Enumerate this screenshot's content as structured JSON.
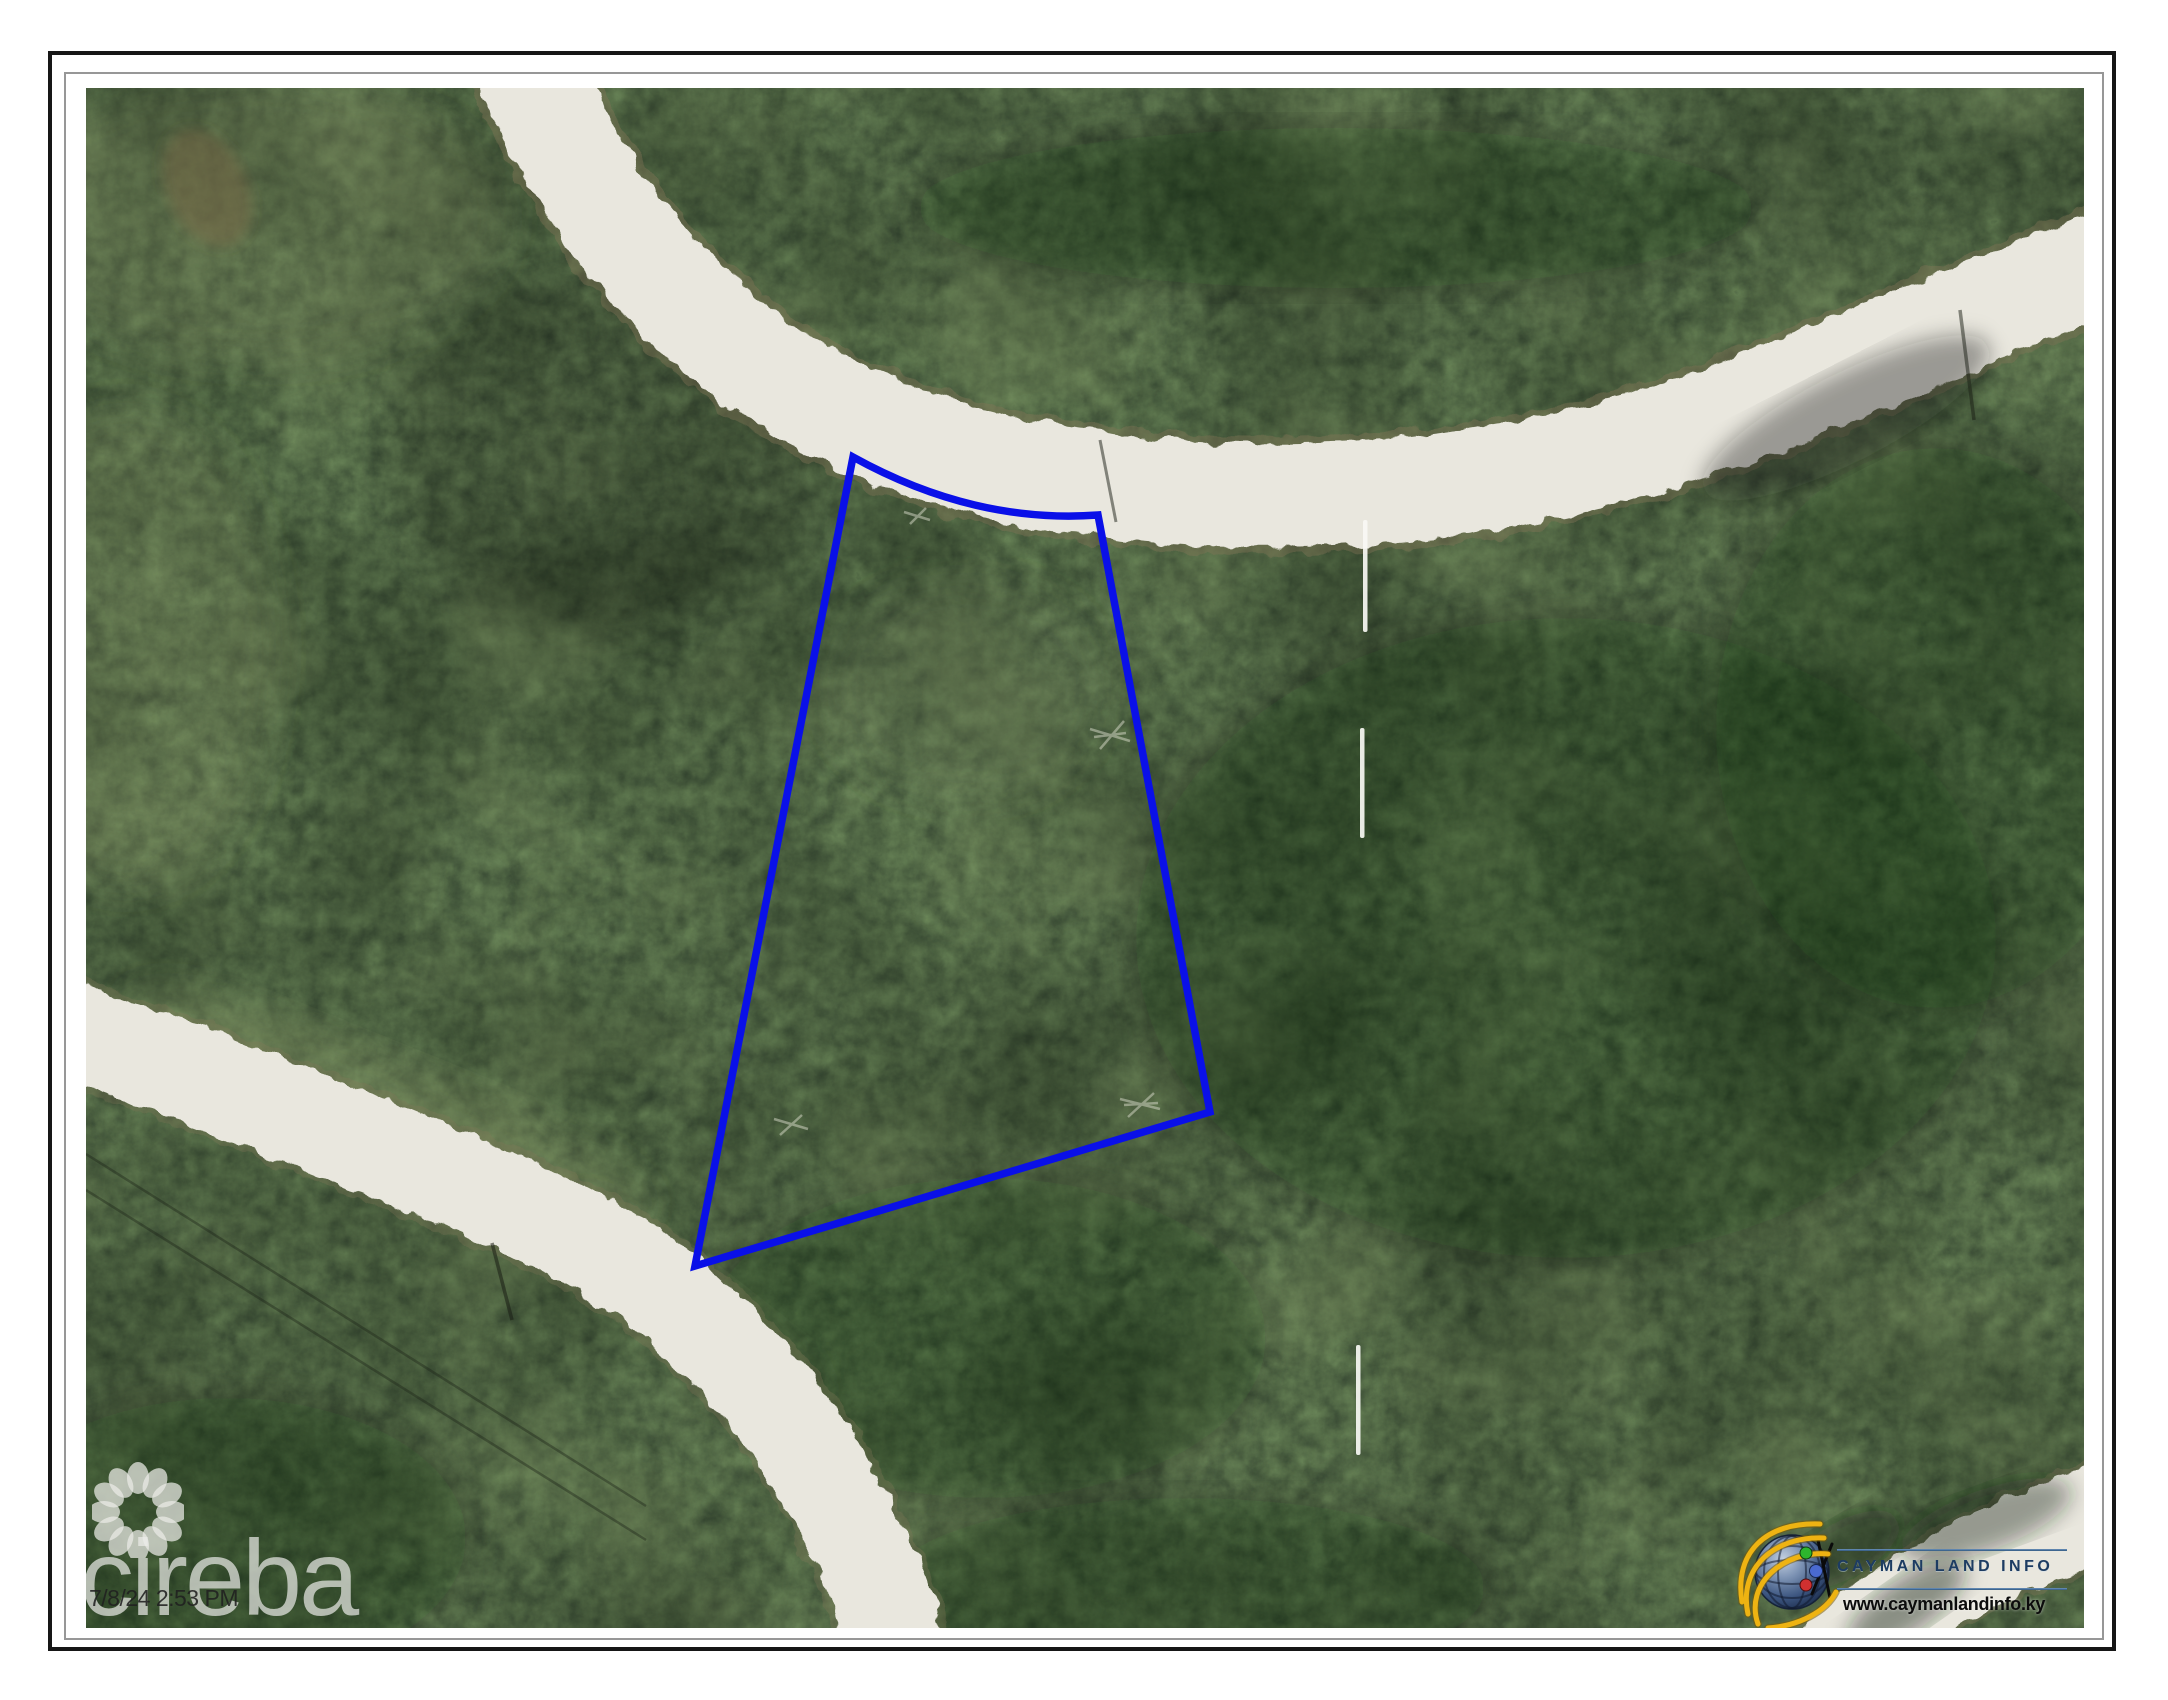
{
  "page": {
    "kind": "printed aerial parcel map sheet",
    "background_color": "#ffffff",
    "outer_frame_color": "#161616",
    "inner_frame_color": "#979797"
  },
  "photo": {
    "type": "aerial-orthophoto",
    "description": "Dense green bushland crossed by white unpaved roads; one vacant land parcel outlined in blue; dashed white survey line segments at right",
    "timestamp": "7/8/24 2:53 PM",
    "watermark": {
      "brand": "cireba",
      "icon": "flower-petal-ring-icon",
      "color": "rgba(237,237,233,0.70)"
    },
    "branding": {
      "name": "CAYMAN LAND INFO",
      "url": "www.caymanlandinfo.ky",
      "icon": "globe-with-orbits-icon",
      "title_color": "#1d3c62",
      "url_color": "#0c0c0c"
    },
    "annotations": {
      "parcel_outline": {
        "color": "#0a10e8",
        "stroke_width_px": 7.5,
        "points_px": [
          [
            767,
            369
          ],
          [
            1012,
            427
          ],
          [
            1124,
            1024
          ],
          [
            609,
            1178
          ]
        ],
        "top_edge_curve_control_px": [
          888,
          436
        ]
      },
      "survey_dash_width_px": 4.5,
      "survey_dashes": [
        {
          "x": 1277,
          "y": 432,
          "height": 112
        },
        {
          "x": 1274,
          "y": 640,
          "height": 110
        },
        {
          "x": 1270,
          "y": 1257,
          "height": 110
        }
      ]
    },
    "colors": {
      "road": "#e9e7de",
      "road_edge_brown": "#84755a",
      "vegetation_dark": "#2c3627",
      "vegetation_mid": "#49573f",
      "vegetation_light": "#6d7f5d",
      "survey_dash": "#f8f8f4"
    }
  }
}
